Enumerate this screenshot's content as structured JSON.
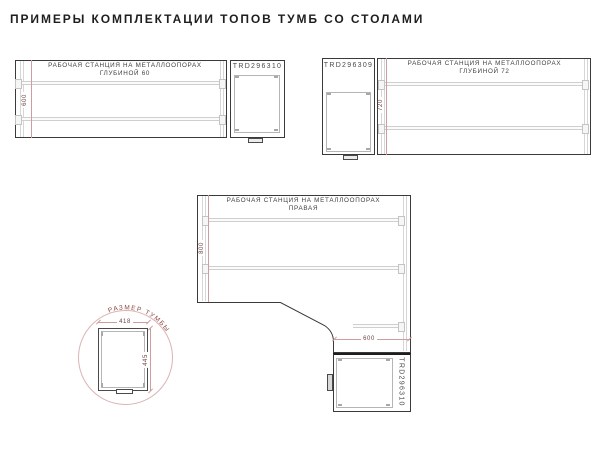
{
  "title": "ПРИМЕРЫ КОМПЛЕКТАЦИИ ТОПОВ ТУМБ СО СТОЛАМИ",
  "diagrams": {
    "depth60": {
      "station_label_line1": "РАБОЧАЯ СТАНЦИЯ НА МЕТАЛЛООПОРАХ",
      "station_label_line2": "ГЛУБИНОЙ 60",
      "depth_dimension": "600",
      "cabinet_code": "TRD296310"
    },
    "depth72": {
      "station_label_line1": "РАБОЧАЯ СТАНЦИЯ НА МЕТАЛЛООПОРАХ",
      "station_label_line2": "ГЛУБИНОЙ 72",
      "depth_dimension": "720",
      "cabinet_code": "TRD296309"
    },
    "corner_right": {
      "station_label_line1": "РАБОЧАЯ СТАНЦИЯ НА МЕТАЛЛООПОРАХ",
      "station_label_line2": "ПРАВАЯ",
      "depth_dimension": "800",
      "cabinet_width_dimension": "600",
      "cabinet_code": "TRD296310"
    },
    "cabinet_detail": {
      "callout_label": "РАЗМЕР ТУМБЫ",
      "width_dimension": "418",
      "depth_dimension": "445"
    }
  },
  "colors": {
    "outline": "#3a3a3a",
    "support_gray": "#cfcfcf",
    "dimension_red": "#cf9d9d",
    "dimension_text": "#6d4343",
    "callout_red": "#8e4444",
    "callout_circle": "#dcb3b3"
  }
}
